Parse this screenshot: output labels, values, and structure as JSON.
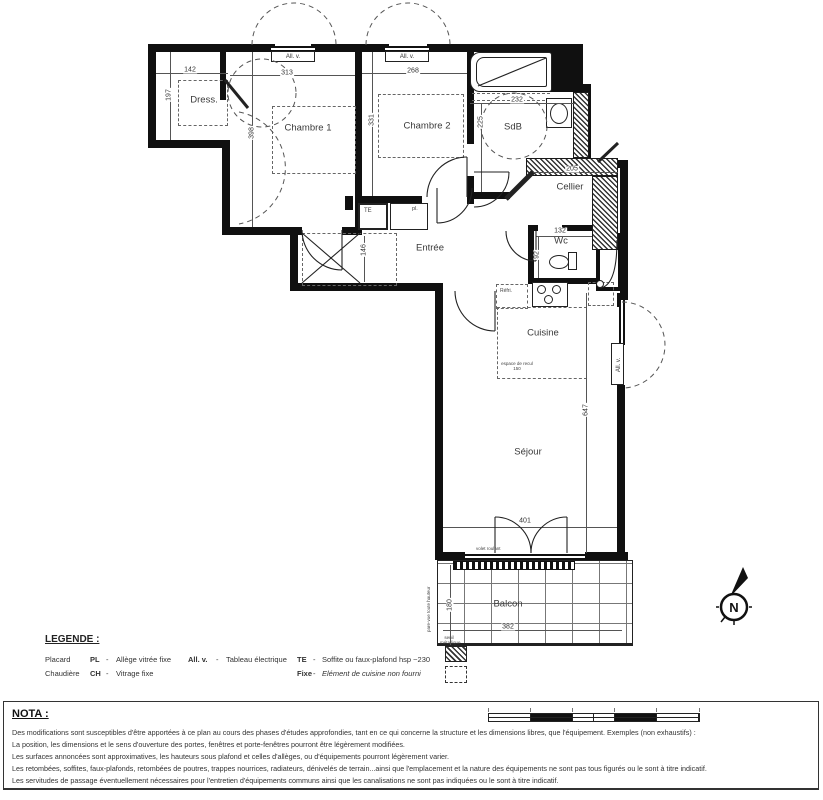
{
  "plan": {
    "rooms": [
      {
        "name": "Dress."
      },
      {
        "name": "Chambre 1"
      },
      {
        "name": "Chambre 2"
      },
      {
        "name": "SdB"
      },
      {
        "name": "Cellier"
      },
      {
        "name": "Wc"
      },
      {
        "name": "Entrée"
      },
      {
        "name": "Cuisine"
      },
      {
        "name": "Séjour"
      },
      {
        "name": "Balcon"
      }
    ],
    "dims": [
      "142",
      "197",
      "313",
      "268",
      "398",
      "331",
      "232",
      "225",
      "205",
      "132",
      "92",
      "146",
      "647",
      "401",
      "180",
      "382"
    ],
    "annotations": {
      "window_label": "All. v.",
      "te": "TE",
      "pl": "pl.",
      "fridge": "Réfri.",
      "recul": "espace de recul 150",
      "volet": "volet roulant",
      "parevue": "pare-vue toute hauteur",
      "seuil": "seuil métallique",
      "compass": "N"
    }
  },
  "legend": {
    "title": "LEGENDE :",
    "rows": [
      {
        "term": "Placard",
        "abbr": "PL",
        "sep1": "-",
        "def1": "Allège vitrée fixe",
        "abbr2": "All. v.",
        "sep2": "-",
        "def2": "Tableau électrique",
        "abbr3": "TE",
        "sep3": "-",
        "def3": "Soffite ou faux-plafond hsp ~230"
      },
      {
        "term": "Chaudière",
        "abbr": "CH",
        "sep1": "-",
        "def1": "Vitrage fixe",
        "abbr3": "Fixe",
        "sep3": "-",
        "def3": "Elément de cuisine non fourni"
      }
    ]
  },
  "nota": {
    "title": "NOTA :",
    "lines": [
      "Des modifications sont susceptibles d'être apportées à ce plan au cours des phases d'études approfondies, tant en ce qui concerne la structure et les dimensions libres, que l'équipement. Exemples (non exhaustifs) :",
      "La position, les dimensions et le sens d'ouverture des portes, fenêtres et porte-fenêtres pourront être légèrement modifiées.",
      "Les surfaces annoncées sont approximatives, les hauteurs sous plafond et celles d'allèges, ou d'équipements pourront légèrement varier.",
      "Les retombées, soffites, faux-plafonds, retombées de poutres, trappes nourrices, radiateurs, dénivelés de terrain...ainsi que l'emplacement et la nature des équipements ne sont pas tous figurés ou le sont à titre indicatif.",
      "Les servitudes de passage éventuellement nécessaires pour l'entretien d'équipements communs ainsi que les canalisations ne sont pas indiquées ou le sont à titre indicatif."
    ]
  }
}
